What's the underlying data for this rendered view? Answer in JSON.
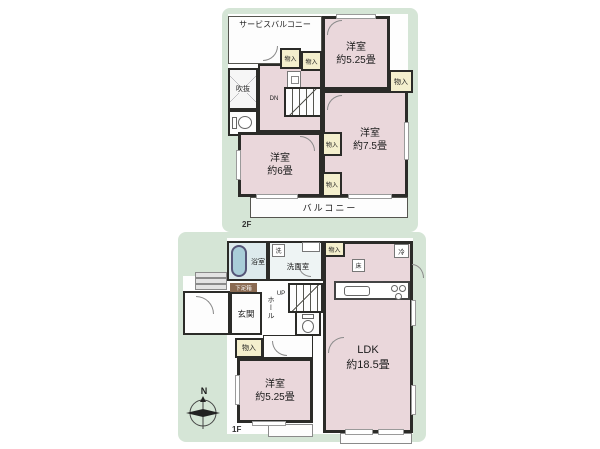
{
  "colors": {
    "background": "#ffffff",
    "panel_green": "#d5e5d6",
    "room_pink": "#ead7db",
    "closet_yellow": "#f4efcd",
    "wet_blue": "#ddeaec",
    "tub_blue": "#a9cdd8",
    "wall": "#2b2b28",
    "shoebox_brown": "#8a6a52"
  },
  "floor2": {
    "floor_label": "2F",
    "service_balcony": "サービスバルコニー",
    "bedroom_ne": {
      "name": "洋室",
      "size": "約5.25畳"
    },
    "bedroom_e": {
      "name": "洋室",
      "size": "約7.5畳"
    },
    "bedroom_w": {
      "name": "洋室",
      "size": "約6畳"
    },
    "void": "吹抜",
    "stairs": "DN",
    "closet": "物入",
    "balcony": "バルコニー"
  },
  "floor1": {
    "floor_label": "1F",
    "bath": "浴室",
    "washroom": "洗面室",
    "washer": "洗",
    "fridge": "冷",
    "floor_storage": "床",
    "ldk": {
      "name": "LDK",
      "size": "約18.5畳"
    },
    "stairs": "UP",
    "hall": "ホール",
    "shoe_cabinet": "下足箱",
    "entrance": "玄関",
    "closet": "物入",
    "bedroom_s": {
      "name": "洋室",
      "size": "約5.25畳"
    },
    "compass_north": "N"
  }
}
